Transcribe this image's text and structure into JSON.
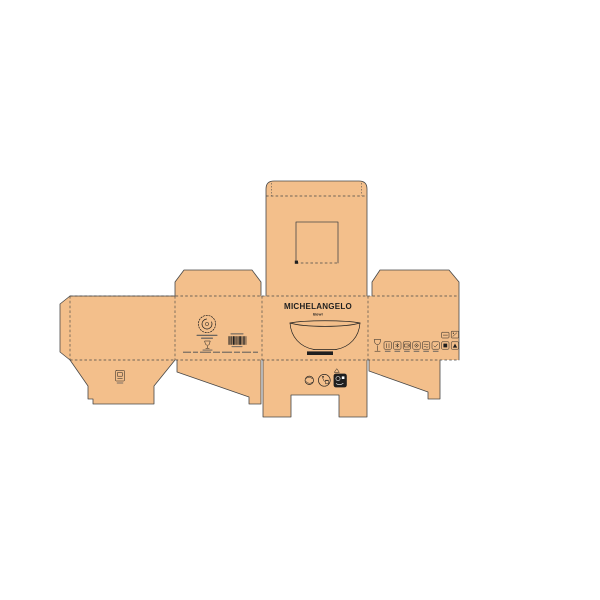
{
  "colors": {
    "background": "#ffffff",
    "board": "#f3bf8b",
    "line": "#474747",
    "ink": "#1f1f1f",
    "print_gray": "#5a5a5a"
  },
  "front_panel": {
    "brand": "MICHELANGELO",
    "subtitle": "Bowl",
    "illustration": "bowl-line-drawing-with-black-base"
  },
  "back_panel": {
    "feature": "square-window-cutout-with-dashed-tear-line"
  },
  "left_panel": {
    "icons": [
      "circular-stamp-logo",
      "award-icon",
      "barcode"
    ],
    "caption_lines_present": true,
    "fine_print_present": true
  },
  "right_panel": {
    "icons": [
      "wine-glass-icon",
      "care-symbol-1",
      "care-symbol-2",
      "care-symbol-3",
      "care-symbol-4",
      "care-symbol-5",
      "care-symbol-6",
      "care-symbol-7",
      "care-symbol-8",
      "info-tag-1",
      "info-tag-2"
    ]
  },
  "bottom_flap": {
    "icons": [
      "green-dot-recycle-icon",
      "tidyman-icon",
      "black-certification-badge",
      "paper-recycle-triangle-icon"
    ]
  },
  "left_bottom_flap": {
    "icons": [
      "small-certification-icon"
    ]
  }
}
